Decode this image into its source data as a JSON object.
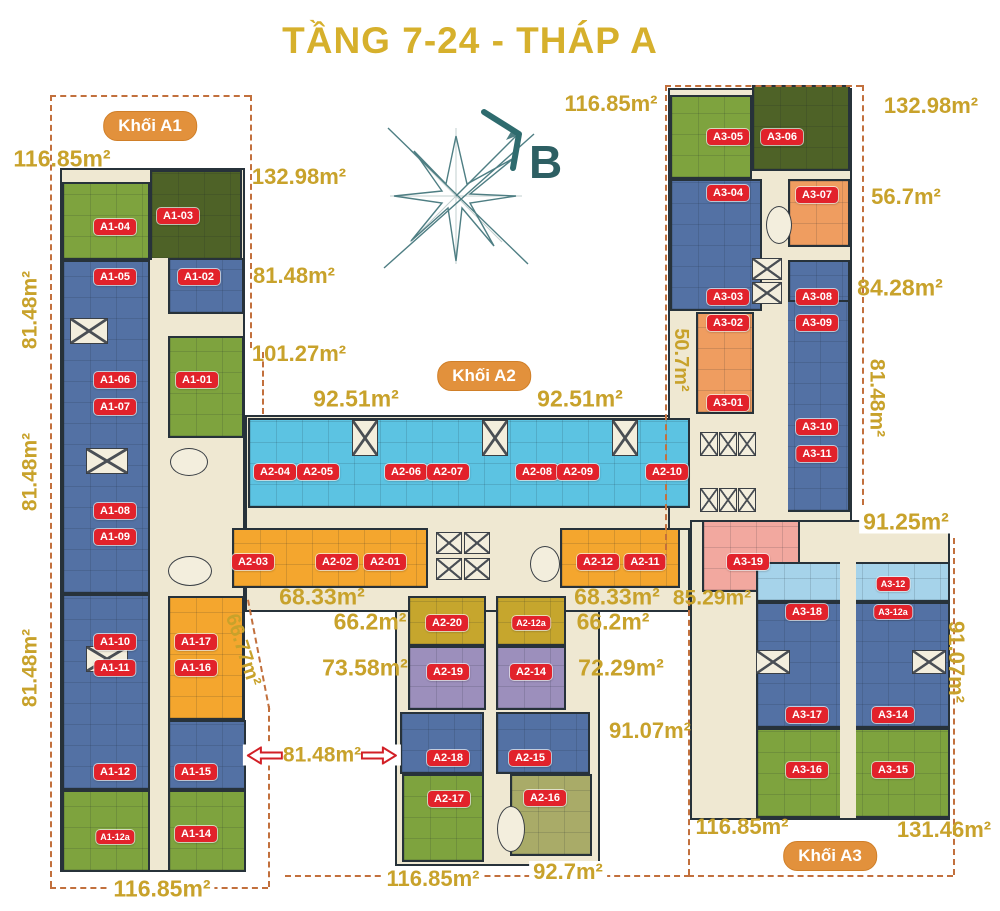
{
  "title": "TẦNG 7-24 - THÁP A",
  "compass": {
    "label": "B"
  },
  "badges": [
    {
      "id": "khoi-a1",
      "label": "Khối A1",
      "x": 150,
      "y": 126
    },
    {
      "id": "khoi-a2",
      "label": "Khối A2",
      "x": 484,
      "y": 376
    },
    {
      "id": "khoi-a3",
      "label": "Khối A3",
      "x": 830,
      "y": 856
    }
  ],
  "units": [
    {
      "id": "A1-04",
      "x": 115,
      "y": 227
    },
    {
      "id": "A1-03",
      "x": 178,
      "y": 216
    },
    {
      "id": "A1-05",
      "x": 115,
      "y": 277
    },
    {
      "id": "A1-02",
      "x": 199,
      "y": 277
    },
    {
      "id": "A1-06",
      "x": 115,
      "y": 380
    },
    {
      "id": "A1-07",
      "x": 115,
      "y": 407
    },
    {
      "id": "A1-01",
      "x": 197,
      "y": 380
    },
    {
      "id": "A1-08",
      "x": 115,
      "y": 511
    },
    {
      "id": "A1-09",
      "x": 115,
      "y": 537
    },
    {
      "id": "A1-10",
      "x": 115,
      "y": 642
    },
    {
      "id": "A1-11",
      "x": 115,
      "y": 668
    },
    {
      "id": "A1-17",
      "x": 196,
      "y": 642
    },
    {
      "id": "A1-16",
      "x": 196,
      "y": 668
    },
    {
      "id": "A1-12",
      "x": 115,
      "y": 772
    },
    {
      "id": "A1-15",
      "x": 196,
      "y": 772
    },
    {
      "id": "A1-12a",
      "x": 115,
      "y": 837,
      "small": true
    },
    {
      "id": "A1-14",
      "x": 196,
      "y": 834
    },
    {
      "id": "A2-04",
      "x": 275,
      "y": 472
    },
    {
      "id": "A2-05",
      "x": 318,
      "y": 472
    },
    {
      "id": "A2-06",
      "x": 406,
      "y": 472
    },
    {
      "id": "A2-07",
      "x": 448,
      "y": 472
    },
    {
      "id": "A2-08",
      "x": 537,
      "y": 472
    },
    {
      "id": "A2-09",
      "x": 578,
      "y": 472
    },
    {
      "id": "A2-10",
      "x": 667,
      "y": 472
    },
    {
      "id": "A2-03",
      "x": 253,
      "y": 562
    },
    {
      "id": "A2-02",
      "x": 337,
      "y": 562
    },
    {
      "id": "A2-01",
      "x": 385,
      "y": 562
    },
    {
      "id": "A2-12",
      "x": 598,
      "y": 562
    },
    {
      "id": "A2-11",
      "x": 645,
      "y": 562
    },
    {
      "id": "A2-20",
      "x": 447,
      "y": 623
    },
    {
      "id": "A2-12a",
      "x": 531,
      "y": 623,
      "small": true
    },
    {
      "id": "A2-19",
      "x": 448,
      "y": 672
    },
    {
      "id": "A2-14",
      "x": 531,
      "y": 672
    },
    {
      "id": "A2-18",
      "x": 448,
      "y": 758
    },
    {
      "id": "A2-15",
      "x": 530,
      "y": 758
    },
    {
      "id": "A2-17",
      "x": 449,
      "y": 799
    },
    {
      "id": "A2-16",
      "x": 545,
      "y": 798
    },
    {
      "id": "A3-05",
      "x": 728,
      "y": 137
    },
    {
      "id": "A3-06",
      "x": 782,
      "y": 137
    },
    {
      "id": "A3-04",
      "x": 728,
      "y": 193
    },
    {
      "id": "A3-07",
      "x": 817,
      "y": 195
    },
    {
      "id": "A3-03",
      "x": 728,
      "y": 297
    },
    {
      "id": "A3-08",
      "x": 817,
      "y": 297
    },
    {
      "id": "A3-02",
      "x": 728,
      "y": 323
    },
    {
      "id": "A3-09",
      "x": 817,
      "y": 323
    },
    {
      "id": "A3-01",
      "x": 728,
      "y": 403
    },
    {
      "id": "A3-10",
      "x": 817,
      "y": 427
    },
    {
      "id": "A3-11",
      "x": 817,
      "y": 454
    },
    {
      "id": "A3-19",
      "x": 748,
      "y": 562
    },
    {
      "id": "A3-12",
      "x": 893,
      "y": 584,
      "small": true
    },
    {
      "id": "A3-18",
      "x": 807,
      "y": 612
    },
    {
      "id": "A3-12a",
      "x": 893,
      "y": 612,
      "small": true
    },
    {
      "id": "A3-17",
      "x": 807,
      "y": 715
    },
    {
      "id": "A3-14",
      "x": 893,
      "y": 715
    },
    {
      "id": "A3-16",
      "x": 807,
      "y": 770
    },
    {
      "id": "A3-15",
      "x": 893,
      "y": 770
    }
  ],
  "area_labels": [
    {
      "text": "116.85m²",
      "x": 62,
      "y": 159,
      "size": 23
    },
    {
      "text": "132.98m²",
      "x": 299,
      "y": 177,
      "size": 22
    },
    {
      "text": "81.48m²",
      "x": 294,
      "y": 276,
      "size": 22
    },
    {
      "text": "101.27m²",
      "x": 299,
      "y": 354,
      "size": 22
    },
    {
      "text": "92.51m²",
      "x": 356,
      "y": 399,
      "size": 23
    },
    {
      "text": "92.51m²",
      "x": 580,
      "y": 399,
      "size": 23
    },
    {
      "text": "116.85m²",
      "x": 611,
      "y": 104,
      "size": 22
    },
    {
      "text": "132.98m²",
      "x": 931,
      "y": 106,
      "size": 22
    },
    {
      "text": "56.7m²",
      "x": 906,
      "y": 197,
      "size": 22
    },
    {
      "text": "84.28m²",
      "x": 900,
      "y": 288,
      "size": 23
    },
    {
      "text": "50.7m²",
      "x": 681,
      "y": 360,
      "size": 20,
      "rot": 90
    },
    {
      "text": "81.48m²",
      "x": 877,
      "y": 398,
      "size": 21,
      "rot": 90
    },
    {
      "text": "91.25m²",
      "x": 906,
      "y": 522,
      "size": 23,
      "bg": true
    },
    {
      "text": "81.48m²",
      "x": 30,
      "y": 310,
      "size": 21,
      "rot": -90
    },
    {
      "text": "81.48m²",
      "x": 30,
      "y": 472,
      "size": 21,
      "rot": -90
    },
    {
      "text": "81.48m²",
      "x": 30,
      "y": 668,
      "size": 21,
      "rot": -90
    },
    {
      "text": "66.77m²",
      "x": 243,
      "y": 650,
      "size": 20,
      "rot": 72
    },
    {
      "text": "68.33m²",
      "x": 322,
      "y": 597,
      "size": 23
    },
    {
      "text": "66.2m²",
      "x": 370,
      "y": 622,
      "size": 23
    },
    {
      "text": "73.58m²",
      "x": 365,
      "y": 668,
      "size": 23
    },
    {
      "text": "68.33m²",
      "x": 617,
      "y": 597,
      "size": 23
    },
    {
      "text": "66.2m²",
      "x": 613,
      "y": 622,
      "size": 23
    },
    {
      "text": "72.29m²",
      "x": 621,
      "y": 668,
      "size": 23
    },
    {
      "text": "85.29m²",
      "x": 712,
      "y": 598,
      "size": 21
    },
    {
      "text": "91.07m²",
      "x": 650,
      "y": 731,
      "size": 22
    },
    {
      "text": "91.07m²",
      "x": 956,
      "y": 662,
      "size": 22,
      "rot": 90
    },
    {
      "text": "81.48m²",
      "x": 322,
      "y": 755,
      "size": 21,
      "arrows": true,
      "bg": true
    },
    {
      "text": "116.85m²",
      "x": 162,
      "y": 889,
      "size": 23,
      "bg": true
    },
    {
      "text": "116.85m²",
      "x": 433,
      "y": 879,
      "size": 22,
      "bg": true
    },
    {
      "text": "92.7m²",
      "x": 568,
      "y": 872,
      "size": 22,
      "bg": true
    },
    {
      "text": "116.85m²",
      "x": 742,
      "y": 827,
      "size": 22
    },
    {
      "text": "131.46m²",
      "x": 944,
      "y": 830,
      "size": 22
    }
  ],
  "colors": {
    "title_gold": "#d6b02c",
    "area_gold": "#c8a22b",
    "unit_badge_red": "#e2222b",
    "block_badge_orange": "#e2913c",
    "compass_teal": "#2e6b6e",
    "boundary_dash": "#c2703d"
  }
}
